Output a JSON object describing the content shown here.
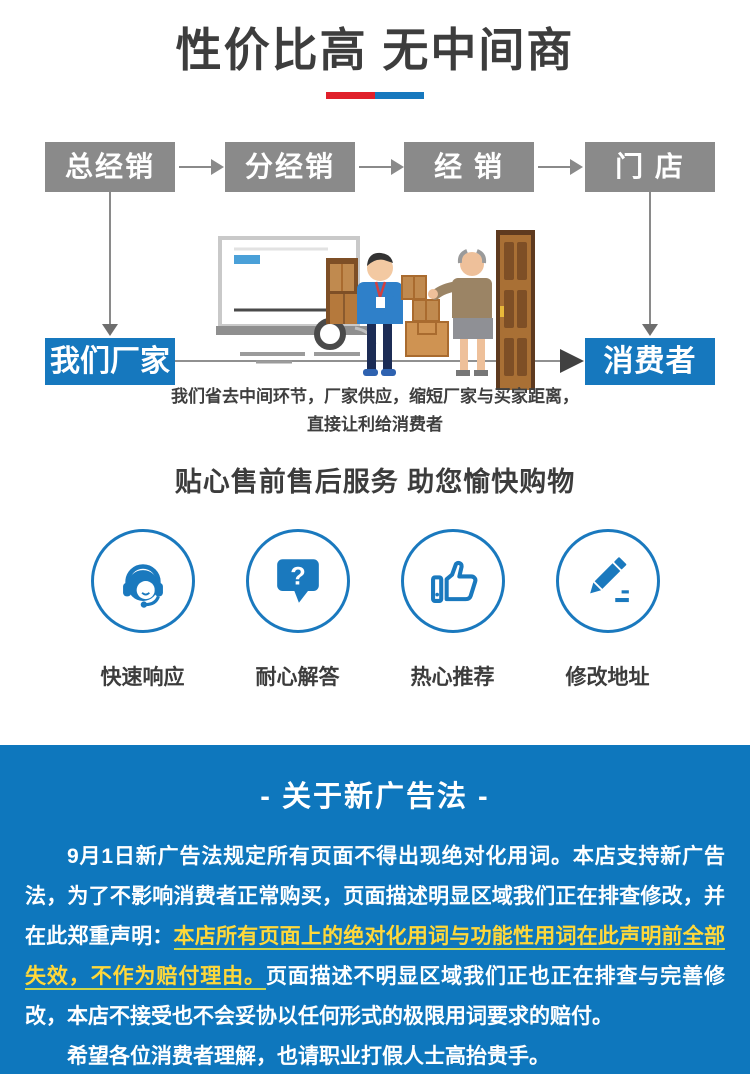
{
  "header": {
    "title": "性价比高 无中间商",
    "underline_colors": {
      "red": "#e0202a",
      "blue": "#1678be"
    }
  },
  "flow": {
    "chain": [
      "总经销",
      "分经销",
      "经 销",
      "门 店"
    ],
    "factory_label": "我们厂家",
    "consumer_label": "消费者",
    "caption": "我们省去中间环节，厂家供应，缩短厂家与买家距离，直接让利给消费者",
    "colors": {
      "chain_box": "#8a8a8a",
      "end_box": "#1678be",
      "arrow_dark": "#414141"
    }
  },
  "services": {
    "heading": "贴心售前售后服务 助您愉快购物",
    "accent_color": "#1a79be",
    "items": [
      {
        "icon": "headset-agent-icon",
        "label": "快速响应"
      },
      {
        "icon": "question-bubble-icon",
        "label": "耐心解答",
        "glyph": "?"
      },
      {
        "icon": "thumbs-up-icon",
        "label": "热心推荐"
      },
      {
        "icon": "pencil-edit-icon",
        "label": "修改地址"
      }
    ]
  },
  "notice": {
    "title": "- 关于新广告法 -",
    "background": "#0e77bd",
    "highlight_color": "#ffd83a",
    "paragraph1_part1": "9月1日新广告法规定所有页面不得出现绝对化用词。本店支持新广告法，为了不影响消费者正常购买，页面描述明显区域我们正在排查修改，并在此郑重声明：",
    "paragraph1_highlight": "本店所有页面上的绝对化用词与功能性用词在此声明前全部失效，不作为赔付理由。",
    "paragraph1_part2": "页面描述不明显区域我们正也正在排查与完善修改，本店不接受也不会妥协以任何形式的极限用词要求的赔付。",
    "paragraph2": "希望各位消费者理解，也请职业打假人士高抬贵手。"
  }
}
